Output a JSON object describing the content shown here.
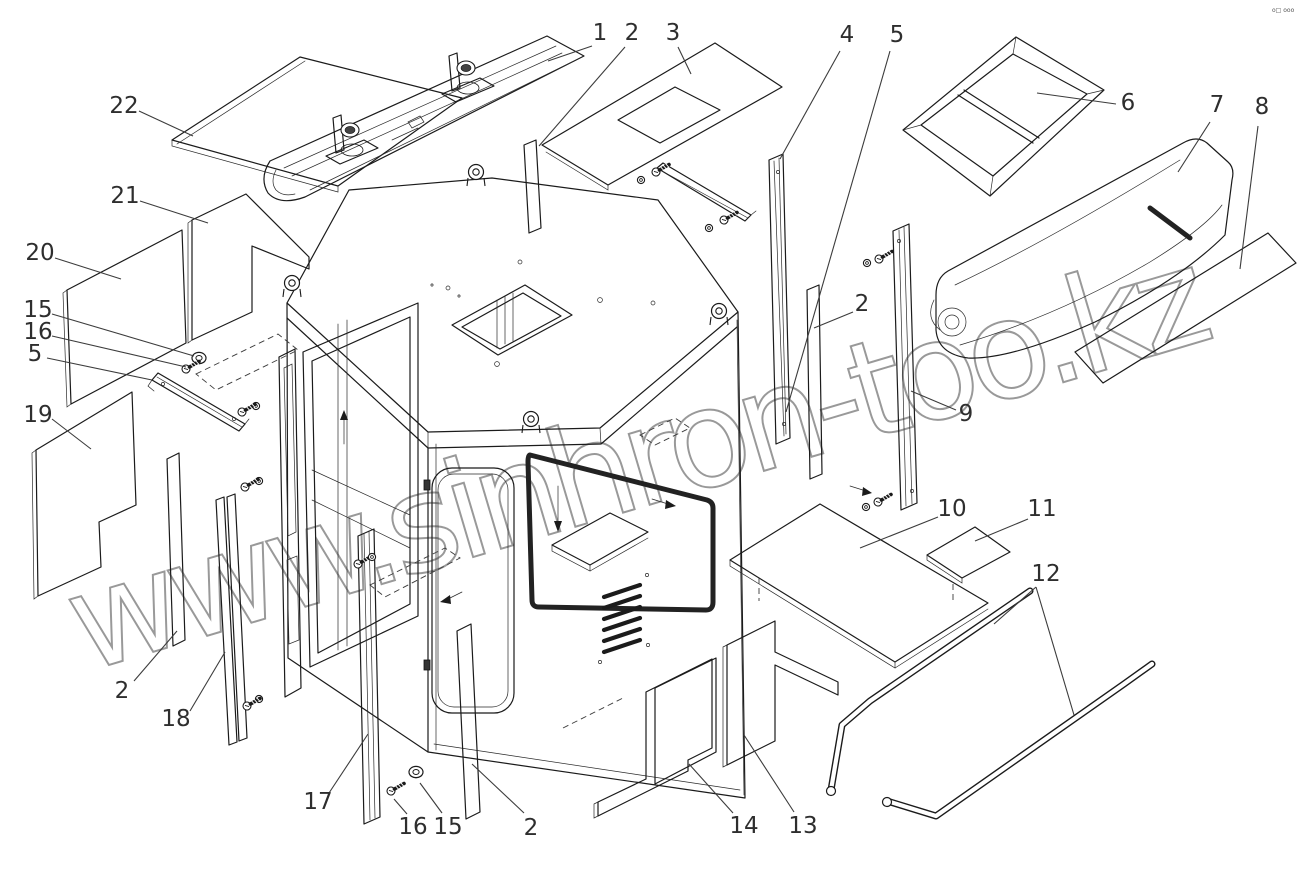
{
  "diagram": {
    "type": "exploded-parts-line-drawing",
    "subject": "operator cab assembly",
    "line_color": "#1b1b1b",
    "background": "#ffffff"
  },
  "watermark": {
    "text": "www.sinhron-too.kz",
    "color": "#8f8f8f"
  },
  "corner_mark": "o□ ooo",
  "callouts": [
    {
      "label": "22",
      "x": 124,
      "y": 106,
      "leaders": [
        [
          [
            139,
            111
          ],
          [
            193,
            136
          ]
        ]
      ]
    },
    {
      "label": "21",
      "x": 125,
      "y": 196,
      "leaders": [
        [
          [
            140,
            201
          ],
          [
            208,
            223
          ]
        ]
      ]
    },
    {
      "label": "20",
      "x": 40,
      "y": 253,
      "leaders": [
        [
          [
            55,
            258
          ],
          [
            121,
            279
          ]
        ]
      ]
    },
    {
      "label": "15",
      "x": 38,
      "y": 310,
      "leaders": [
        [
          [
            52,
            314
          ],
          [
            194,
            356
          ]
        ]
      ]
    },
    {
      "label": "16",
      "x": 38,
      "y": 332,
      "leaders": [
        [
          [
            52,
            336
          ],
          [
            186,
            367
          ]
        ]
      ]
    },
    {
      "label": "5",
      "x": 35,
      "y": 354,
      "leaders": [
        [
          [
            47,
            358
          ],
          [
            152,
            380
          ]
        ]
      ]
    },
    {
      "label": "19",
      "x": 38,
      "y": 415,
      "leaders": [
        [
          [
            52,
            419
          ],
          [
            91,
            449
          ]
        ]
      ]
    },
    {
      "label": "1",
      "x": 600,
      "y": 33,
      "leaders": [
        [
          [
            592,
            46
          ],
          [
            548,
            61
          ]
        ]
      ]
    },
    {
      "label": "2",
      "x": 632,
      "y": 33,
      "leaders": [
        [
          [
            625,
            47
          ],
          [
            539,
            146
          ]
        ]
      ]
    },
    {
      "label": "3",
      "x": 673,
      "y": 33,
      "leaders": [
        [
          [
            678,
            47
          ],
          [
            691,
            74
          ]
        ]
      ]
    },
    {
      "label": "4",
      "x": 847,
      "y": 35,
      "leaders": [
        [
          [
            840,
            51
          ],
          [
            780,
            159
          ]
        ]
      ]
    },
    {
      "label": "5",
      "x": 897,
      "y": 35,
      "leaders": [
        [
          [
            890,
            51
          ],
          [
            786,
            412
          ]
        ]
      ]
    },
    {
      "label": "6",
      "x": 1128,
      "y": 103,
      "leaders": [
        [
          [
            1116,
            104
          ],
          [
            1037,
            93
          ]
        ]
      ]
    },
    {
      "label": "7",
      "x": 1217,
      "y": 105,
      "leaders": [
        [
          [
            1210,
            122
          ],
          [
            1178,
            172
          ]
        ]
      ]
    },
    {
      "label": "8",
      "x": 1262,
      "y": 107,
      "leaders": [
        [
          [
            1258,
            126
          ],
          [
            1240,
            269
          ]
        ]
      ]
    },
    {
      "label": "2",
      "x": 862,
      "y": 304,
      "leaders": [
        [
          [
            853,
            312
          ],
          [
            814,
            328
          ]
        ]
      ]
    },
    {
      "label": "9",
      "x": 966,
      "y": 414,
      "leaders": [
        [
          [
            956,
            410
          ],
          [
            911,
            391
          ]
        ]
      ]
    },
    {
      "label": "10",
      "x": 952,
      "y": 509,
      "leaders": [
        [
          [
            938,
            517
          ],
          [
            860,
            548
          ]
        ]
      ]
    },
    {
      "label": "11",
      "x": 1042,
      "y": 509,
      "leaders": [
        [
          [
            1028,
            519
          ],
          [
            975,
            541
          ]
        ]
      ]
    },
    {
      "label": "12",
      "x": 1046,
      "y": 574,
      "leaders": [
        [
          [
            1036,
            587
          ],
          [
            994,
            624
          ]
        ],
        [
          [
            1036,
            587
          ],
          [
            1074,
            715
          ]
        ]
      ]
    },
    {
      "label": "2",
      "x": 122,
      "y": 691,
      "leaders": [
        [
          [
            134,
            681
          ],
          [
            177,
            631
          ]
        ]
      ]
    },
    {
      "label": "18",
      "x": 176,
      "y": 719,
      "leaders": [
        [
          [
            190,
            711
          ],
          [
            225,
            652
          ]
        ]
      ]
    },
    {
      "label": "17",
      "x": 318,
      "y": 802,
      "leaders": [
        [
          [
            329,
            793
          ],
          [
            368,
            734
          ]
        ]
      ]
    },
    {
      "label": "16",
      "x": 413,
      "y": 827,
      "leaders": [
        [
          [
            407,
            814
          ],
          [
            394,
            799
          ]
        ]
      ]
    },
    {
      "label": "15",
      "x": 448,
      "y": 827,
      "leaders": [
        [
          [
            442,
            813
          ],
          [
            420,
            783
          ]
        ]
      ]
    },
    {
      "label": "2",
      "x": 531,
      "y": 828,
      "leaders": [
        [
          [
            524,
            813
          ],
          [
            472,
            764
          ]
        ]
      ]
    },
    {
      "label": "14",
      "x": 744,
      "y": 826,
      "leaders": [
        [
          [
            733,
            813
          ],
          [
            689,
            764
          ]
        ]
      ]
    },
    {
      "label": "13",
      "x": 803,
      "y": 826,
      "leaders": [
        [
          [
            794,
            812
          ],
          [
            744,
            735
          ]
        ]
      ]
    }
  ]
}
